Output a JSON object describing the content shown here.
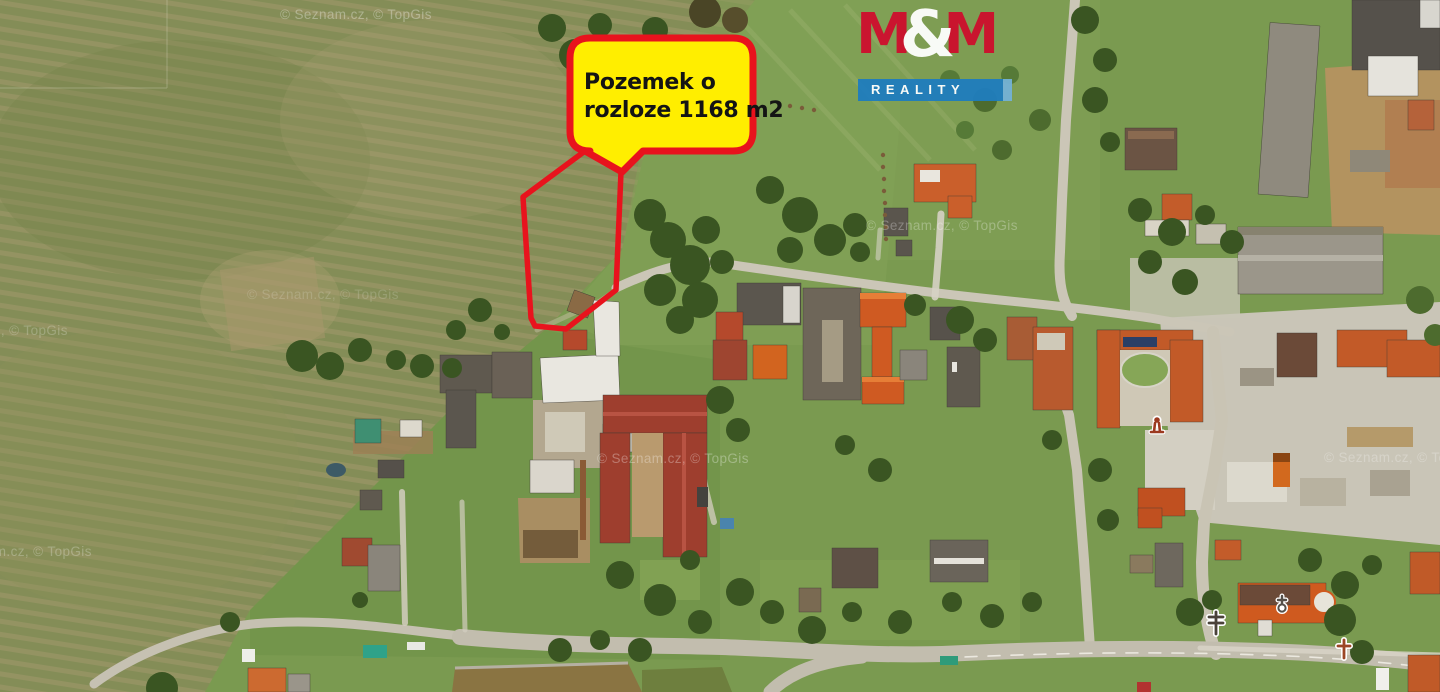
{
  "callout": {
    "line1": "Pozemek o",
    "line2": "rozloze 1168 m2",
    "fill_color": "#ffee00",
    "border_color": "#e8131d"
  },
  "logo": {
    "m1": "M",
    "amp": "&",
    "m2": "M",
    "word": "REALITY",
    "red": "#ce0e2d",
    "blue": "#1f7dbe",
    "light_blue": "#74b2d6"
  },
  "watermark": {
    "text": "© Seznam.cz, © TopGis"
  },
  "map": {
    "type": "aerial-photo",
    "property_outline_color": "#e8131d",
    "poi_icons": [
      "monument-icon",
      "signpost-icon",
      "church-icon",
      "memorial-cross-icon"
    ]
  }
}
